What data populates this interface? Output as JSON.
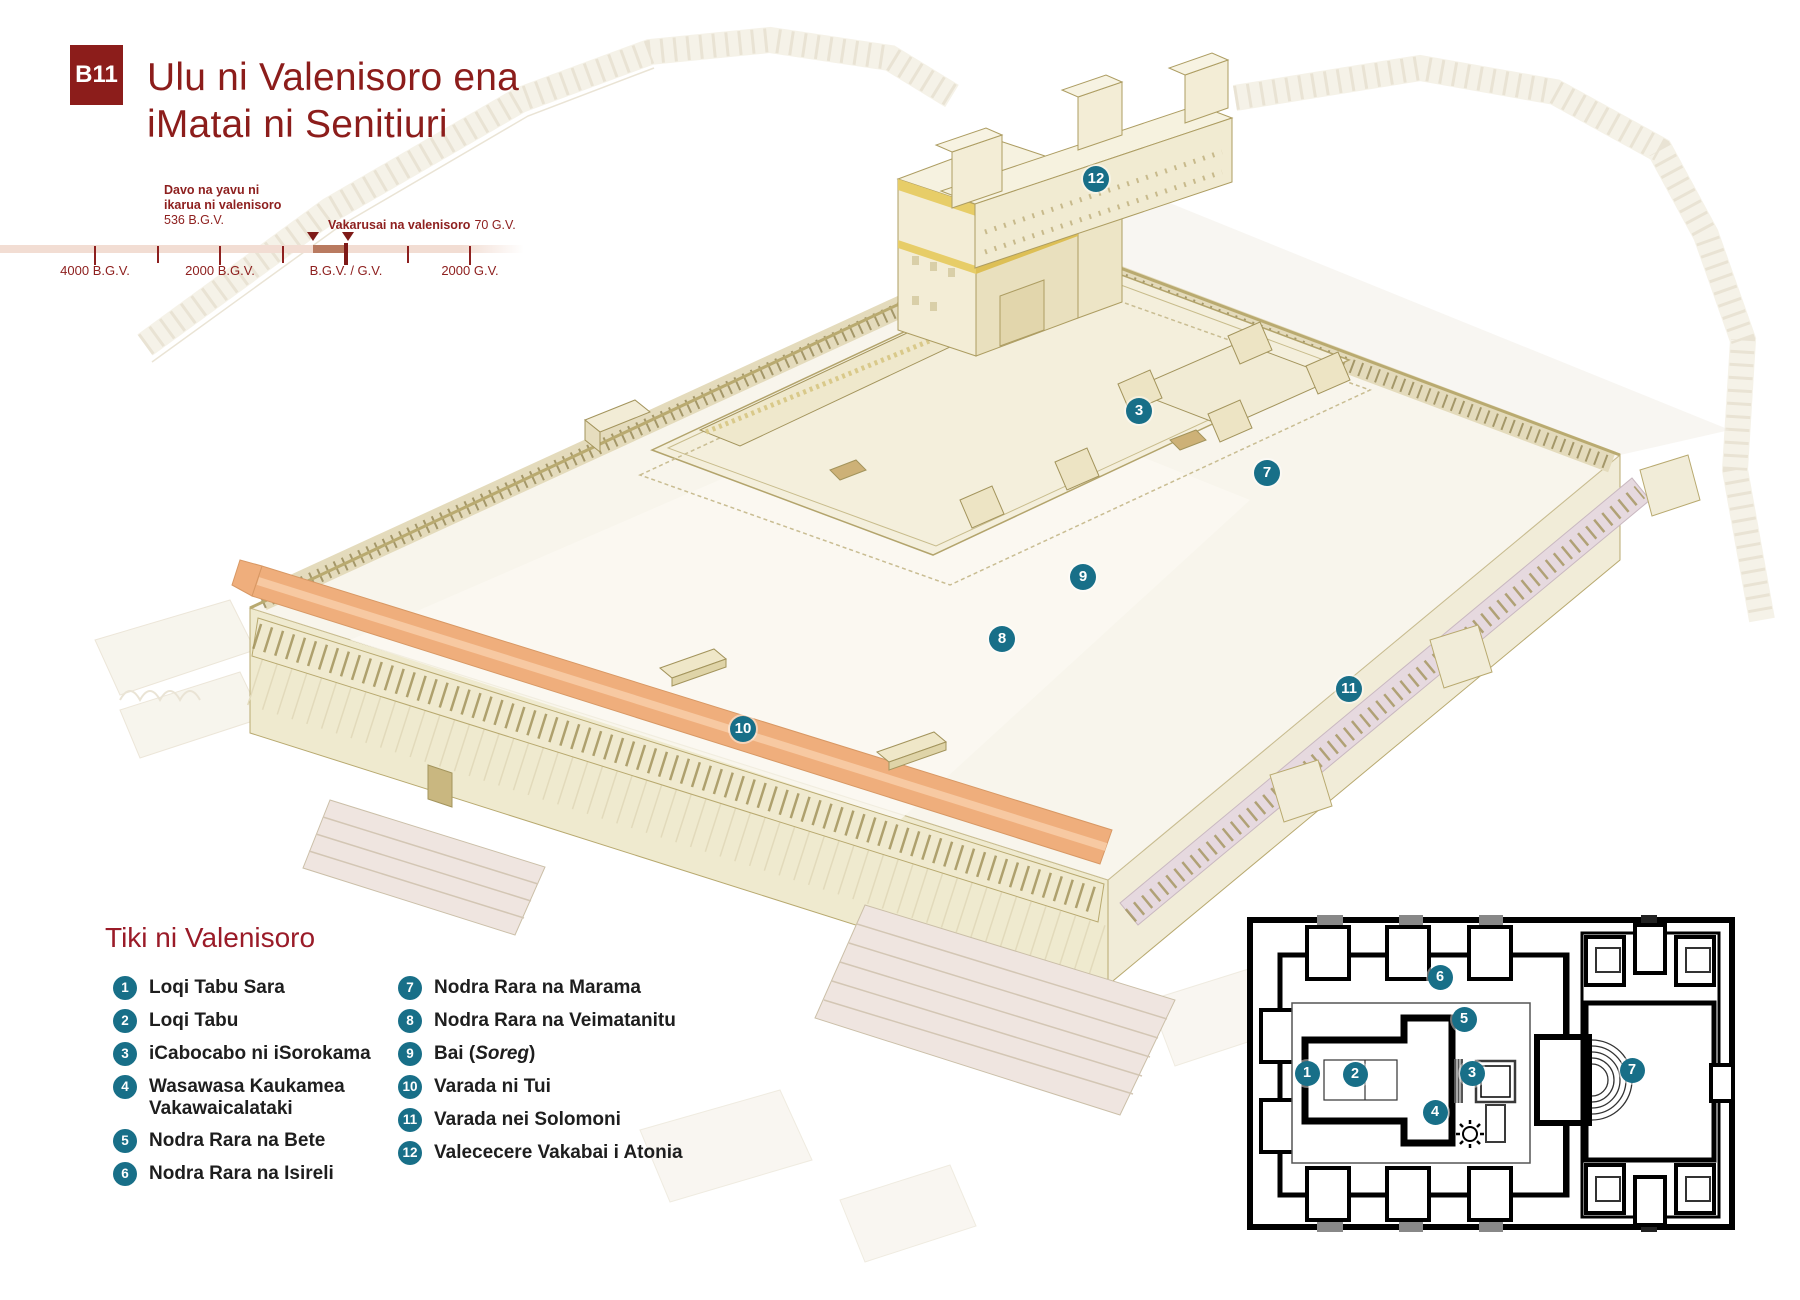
{
  "header": {
    "badge": "B11",
    "title_line1": "Ulu ni Valenisoro ena",
    "title_line2": "iMatai ni Senitiuri"
  },
  "timeline": {
    "event1": {
      "line1": "Davo na yavu ni",
      "line2": "ikarua ni valenisoro",
      "date": "536 B.G.V."
    },
    "event2": {
      "label": "Vakarusai na valenisoro",
      "date": "70 G.V."
    },
    "ticks": [
      "4000 B.G.V.",
      "2000 B.G.V.",
      "B.G.V. / G.V.",
      "2000 G.V."
    ]
  },
  "legend": {
    "title": "Tiki ni Valenisoro",
    "column_break": 6,
    "items": [
      {
        "n": "1",
        "label": "Loqi Tabu Sara"
      },
      {
        "n": "2",
        "label": "Loqi Tabu"
      },
      {
        "n": "3",
        "label": "iCabocabo ni iSorokama"
      },
      {
        "n": "4",
        "label": "Wasawasa Kaukamea Vakawaicalataki"
      },
      {
        "n": "5",
        "label": "Nodra Rara na Bete"
      },
      {
        "n": "6",
        "label": "Nodra Rara na Isireli"
      },
      {
        "n": "7",
        "label": "Nodra Rara na Marama"
      },
      {
        "n": "8",
        "label": "Nodra Rara na Veimatanitu"
      },
      {
        "n": "9",
        "label": "Bai (",
        "italic": "Soreg",
        "suffix": ")"
      },
      {
        "n": "10",
        "label": "Varada ni Tui"
      },
      {
        "n": "11",
        "label": "Varada nei Solomoni"
      },
      {
        "n": "12",
        "label": "Valececere Vakabai i Atonia"
      }
    ]
  },
  "diagram_markers": [
    {
      "n": "3",
      "x": 1139,
      "y": 411
    },
    {
      "n": "7",
      "x": 1267,
      "y": 473
    },
    {
      "n": "9",
      "x": 1083,
      "y": 577
    },
    {
      "n": "8",
      "x": 1002,
      "y": 639
    },
    {
      "n": "10",
      "x": 743,
      "y": 729
    },
    {
      "n": "11",
      "x": 1349,
      "y": 689
    },
    {
      "n": "12",
      "x": 1096,
      "y": 179
    }
  ],
  "floorplan_markers": [
    {
      "n": "1",
      "x": 60,
      "y": 158
    },
    {
      "n": "2",
      "x": 108,
      "y": 159
    },
    {
      "n": "3",
      "x": 225,
      "y": 158
    },
    {
      "n": "4",
      "x": 188,
      "y": 197
    },
    {
      "n": "5",
      "x": 217,
      "y": 104
    },
    {
      "n": "6",
      "x": 193,
      "y": 62
    },
    {
      "n": "7",
      "x": 385,
      "y": 155
    }
  ],
  "colors": {
    "accent_red": "#8C1D1B",
    "legend_red": "#9A1B28",
    "marker_teal": "#186F88",
    "roof_orange": "#EFAE7C",
    "timeline_bar": "#F2DDD3",
    "timeline_range": "#B97A60",
    "wall_cream": "#F2ECD6",
    "gold_trim": "#E7CD68"
  }
}
